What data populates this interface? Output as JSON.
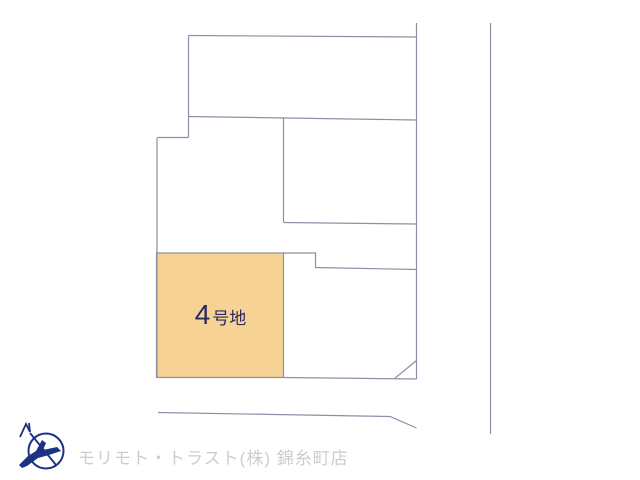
{
  "plan": {
    "type": "land-lot-layout-diagram",
    "highlighted_plot": {
      "number": "4",
      "suffix": "号地",
      "full_label": "4号地",
      "fill": "#f6d394",
      "label_color": "#28285e"
    },
    "line_color": "#8b90a4",
    "background": "#ffffff"
  },
  "footer": {
    "company": "モリモト・トラスト(株) 錦糸町店",
    "logo": "compass-bird-logo",
    "logo_color": "#1b3382",
    "text_color": "#cdcdcd"
  }
}
